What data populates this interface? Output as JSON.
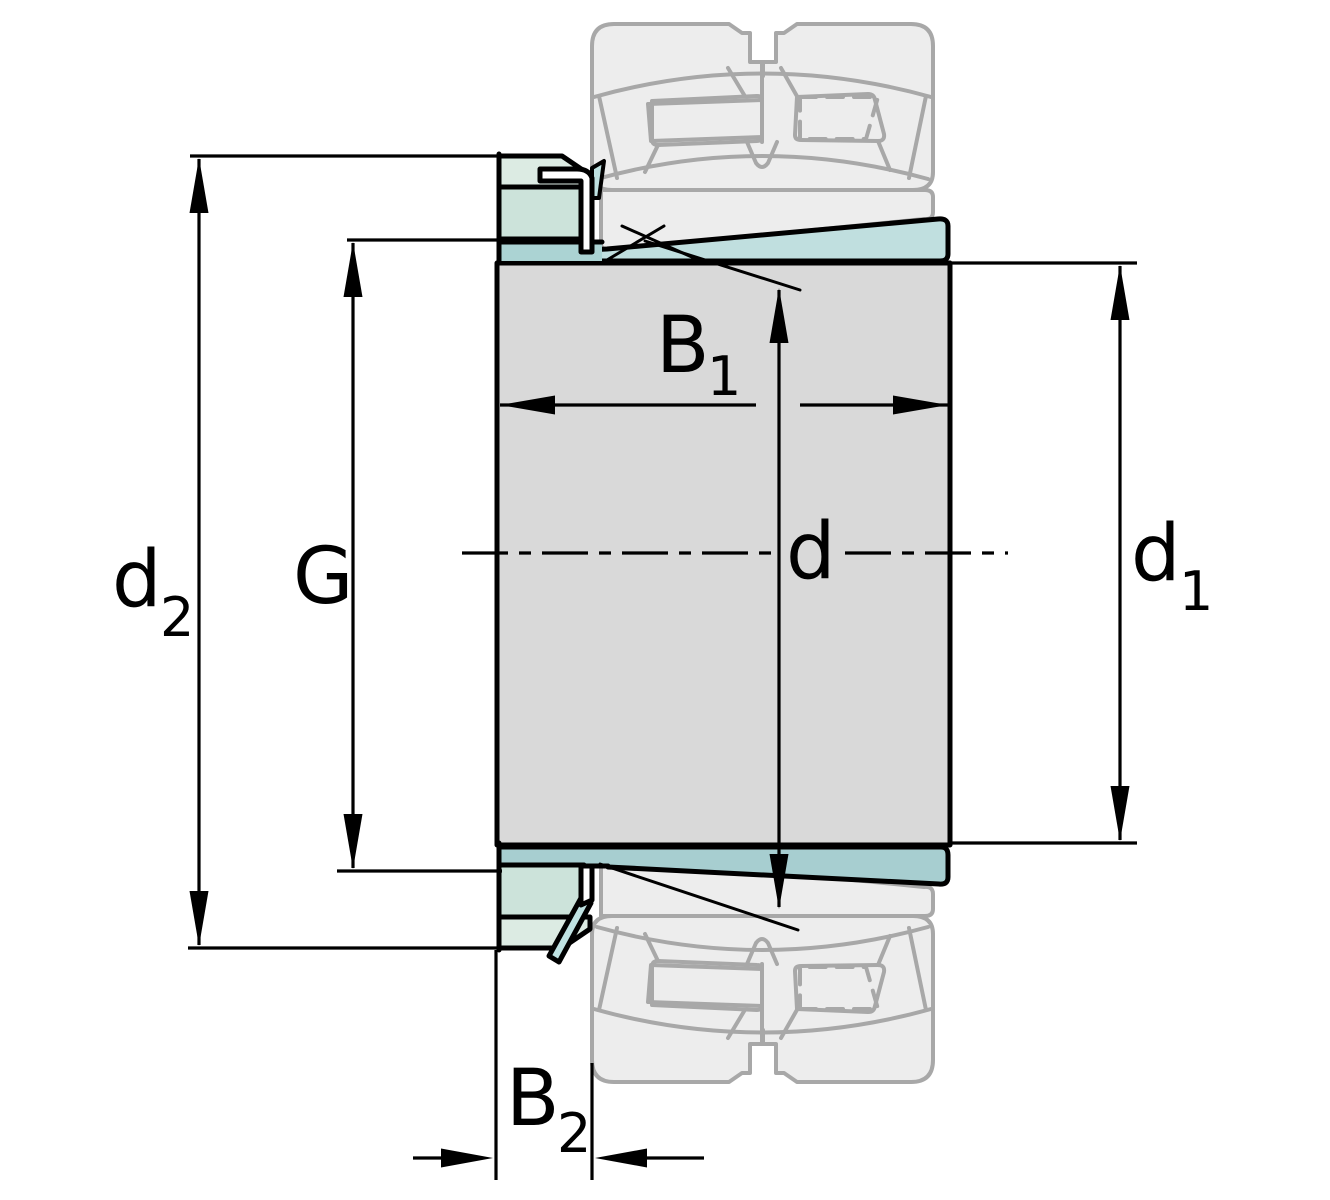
{
  "drawing": {
    "kind": "bearing-adapter-sleeve-cross-section",
    "labels": {
      "d2": {
        "main": "d",
        "sub": "2"
      },
      "G": {
        "main": "G"
      },
      "B1": {
        "main": "B",
        "sub": "1"
      },
      "d": {
        "main": "d"
      },
      "d1": {
        "main": "d",
        "sub": "1"
      },
      "B2": {
        "main": "B",
        "sub": "2"
      }
    },
    "colors": {
      "background": "#ffffff",
      "outline": "#000000",
      "sleeve_grey": "#d9d9d9",
      "taper_cyan": "#c0dfdf",
      "thread_teal": "#abd3d3",
      "taper_bottom_teal": "#a7ced0",
      "nut_face_green": "#cce3da",
      "nut_bevel_green": "#dcebe3",
      "washer_white": "#ffffff",
      "washer_tab_cyan": "#bfe2e2",
      "ghost_fill": "#ededed",
      "ghost_stroke": "#a8a8a8"
    }
  }
}
